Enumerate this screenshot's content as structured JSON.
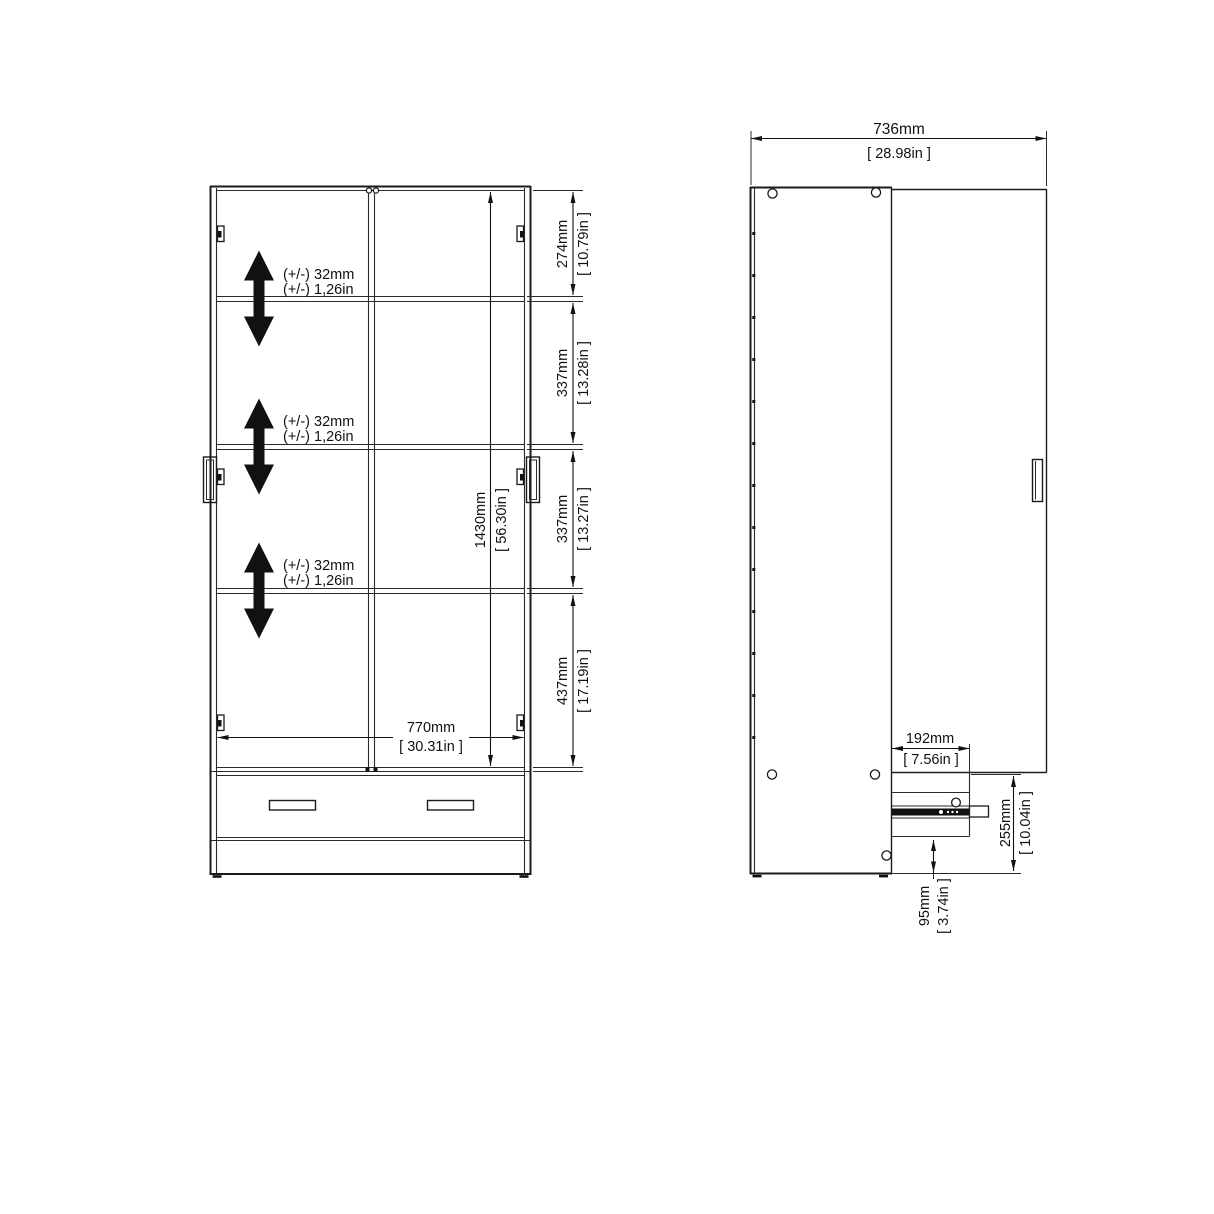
{
  "front_view": {
    "shelf_adjust": [
      {
        "mm": "(+/-) 32mm",
        "inch": "(+/-) 1,26in"
      },
      {
        "mm": "(+/-) 32mm",
        "inch": "(+/-) 1,26in"
      },
      {
        "mm": "(+/-) 32mm",
        "inch": "(+/-) 1,26in"
      }
    ],
    "height_segments": [
      {
        "mm": "274mm",
        "inch": "[ 10.79in ]"
      },
      {
        "mm": "337mm",
        "inch": "[ 13.28in ]"
      },
      {
        "mm": "337mm",
        "inch": "[ 13.27in ]"
      },
      {
        "mm": "437mm",
        "inch": "[ 17.19in ]"
      }
    ],
    "interior_height": {
      "mm": "1430mm",
      "inch": "[ 56.30in ]"
    },
    "interior_width": {
      "mm": "770mm",
      "inch": "[ 30.31in ]"
    }
  },
  "side_view": {
    "depth": {
      "mm": "736mm",
      "inch": "[ 28.98in ]"
    },
    "drawer_depth": {
      "mm": "192mm",
      "inch": "[ 7.56in ]"
    },
    "drawer_section_height": {
      "mm": "255mm",
      "inch": "[ 10.04in ]"
    },
    "drawer_bottom_clearance": {
      "mm": "95mm",
      "inch": "[ 3.74in ]"
    }
  }
}
